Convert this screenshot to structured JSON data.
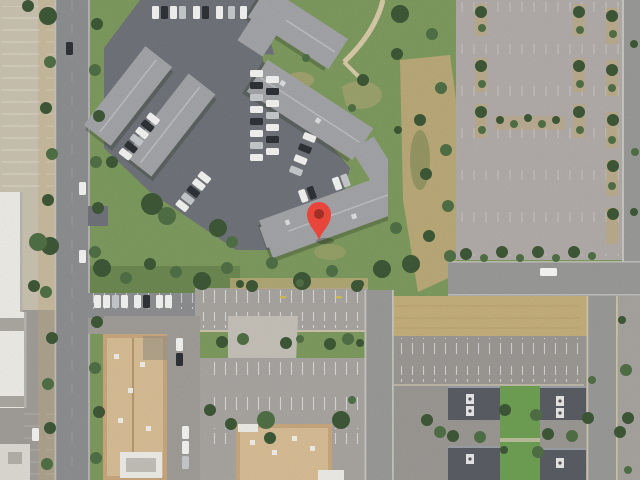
{
  "map": {
    "view_type": "satellite-imagery",
    "size": {
      "width": 640,
      "height": 480
    },
    "marker": {
      "name": "dropped-pin",
      "icon": "map-pin-icon",
      "x": 319,
      "y": 240,
      "body_color": "#E8463B",
      "dot_color": "#A03026"
    },
    "palette": {
      "grass": "#7E9B5F",
      "grass_dark": "#5E7A47",
      "grass_bright": "#6FA054",
      "tree": "#3E5837",
      "tree_light": "#517046",
      "road": "#8D8F91",
      "road_light": "#9A9B99",
      "asphalt": "#70747A",
      "lot_ne": "#B2ADAA",
      "lot_mid": "#A9A6A2",
      "lot_s": "#9C9995",
      "lot_sw": "#A19E99",
      "tan_lot": "#CBC3B1",
      "field": "#C5AF7D",
      "dirt": "#C2AC7C",
      "roof": "#A4A5A8",
      "ridge": "#C6C7C9",
      "roof_dark": "#5A5E64",
      "bldg_tan": "#C9A87E",
      "roof_tan": "#D8BE96",
      "bldg_white": "#EFEDE7",
      "concrete": "#C6C2BA",
      "curb": "#CDC5AE",
      "car_white": "#F4F4F2",
      "car_dark": "#2F3237",
      "car_silver": "#C7CACD",
      "stripe": "#FFFFFF",
      "marker": "#E8463B",
      "marker_dot": "#A03026",
      "truck": "#F8F8F6"
    },
    "features": [
      "west-street",
      "west-parking-lot",
      "white-rooftop-building",
      "apartment-complex",
      "complex-parking-lot",
      "greenbelt-with-trail",
      "northeast-parking-lot",
      "east-street",
      "dry-grass-field",
      "central-parking-lot",
      "tan-office-building-west",
      "tan-office-building-south",
      "southeast-apartment-buildings",
      "south-center-street",
      "southeast-street"
    ]
  }
}
